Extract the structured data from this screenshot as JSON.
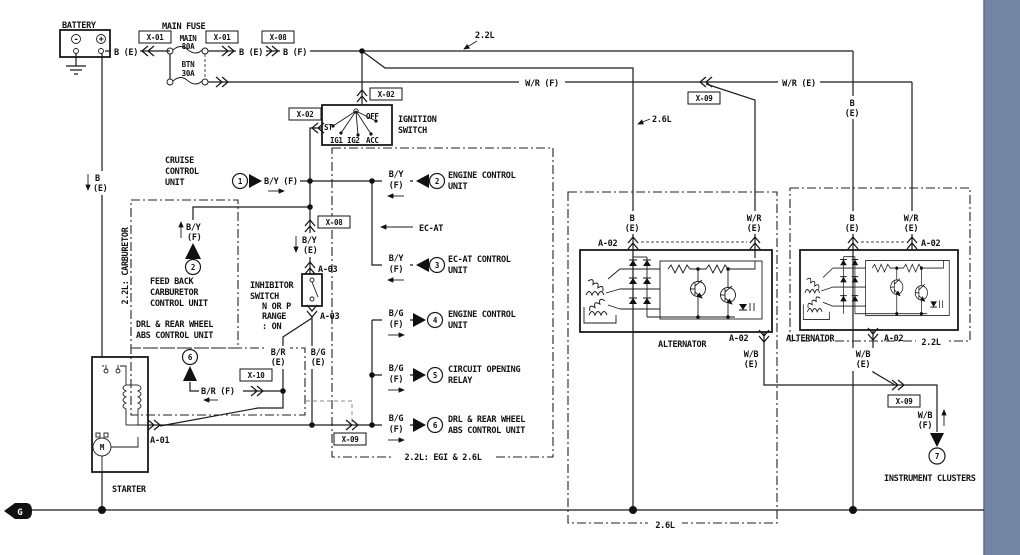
{
  "window": {
    "band_color": "#7386a1",
    "line_color": "#1a1a1a",
    "bg": "#ffffff"
  },
  "connectors": {
    "x01": "X-01",
    "x02": "X-02",
    "x08": "X-08",
    "x09": "X-09",
    "x10": "X-10",
    "a01": "A-01",
    "a02": "A-02",
    "a03": "A-03"
  },
  "wires": {
    "b_e": "B (E)",
    "b_f": "B (F)",
    "by_f": "B/Y (F)",
    "wr_f": "W/R (F)",
    "wr_e": "W/R (E)",
    "br_f": "B/R (F)",
    "b": "B",
    "wr": "W/R",
    "wb": "W/B",
    "by": "B/Y",
    "bg": "B/G",
    "br": "B/R",
    "e": "(E)",
    "f": "(F)"
  },
  "battery": {
    "label": "BATTERY",
    "minus": "-",
    "plus": "+"
  },
  "fuse": {
    "header": "MAIN FUSE",
    "main_name": "MAIN",
    "main_rating": "80A",
    "btn_name": "BTN",
    "btn_rating": "30A"
  },
  "ignition": {
    "line1": "IGNITION",
    "line2": "SWITCH",
    "st": "ST",
    "ig1": "IG1",
    "ig2": "IG2",
    "acc": "ACC",
    "off": "OFF"
  },
  "inhibitor": {
    "line1": "INHIBITOR",
    "line2": "SWITCH",
    "cond1": "N OR P",
    "cond2": "RANGE",
    "cond3": ": ON"
  },
  "units": {
    "cruise1": "CRUISE",
    "cruise2": "CONTROL",
    "cruise3": "UNIT",
    "feedback1": "FEED BACK",
    "feedback2": "CARBURETOR",
    "feedback3": "CONTROL UNIT",
    "drl1": "DRL & REAR WHEEL",
    "drl2": "ABS CONTROL UNIT",
    "engine1": "ENGINE CONTROL",
    "engine2": "UNIT",
    "ecat1": "EC-AT CONTROL",
    "ecat2": "UNIT",
    "relay1": "CIRCUIT OPENING",
    "relay2": "RELAY",
    "starter": "STARTER",
    "alternator": "ALTERNATOR",
    "clusters": "INSTRUMENT CLUSTERS"
  },
  "annotations": {
    "ecat": "EC-AT",
    "top22": "2.2L",
    "mid26": "2.6L",
    "zone_carb": "2.2L: CARBURETOR",
    "zone_egi": "2.2L: EGI & 2.6L",
    "zone26": "2.6L",
    "zone22": "2.2L",
    "ground": "G"
  },
  "refs": {
    "r1": "1",
    "r2": "2",
    "r3": "3",
    "r4": "4",
    "r5": "5",
    "r6": "6",
    "r7": "7"
  }
}
